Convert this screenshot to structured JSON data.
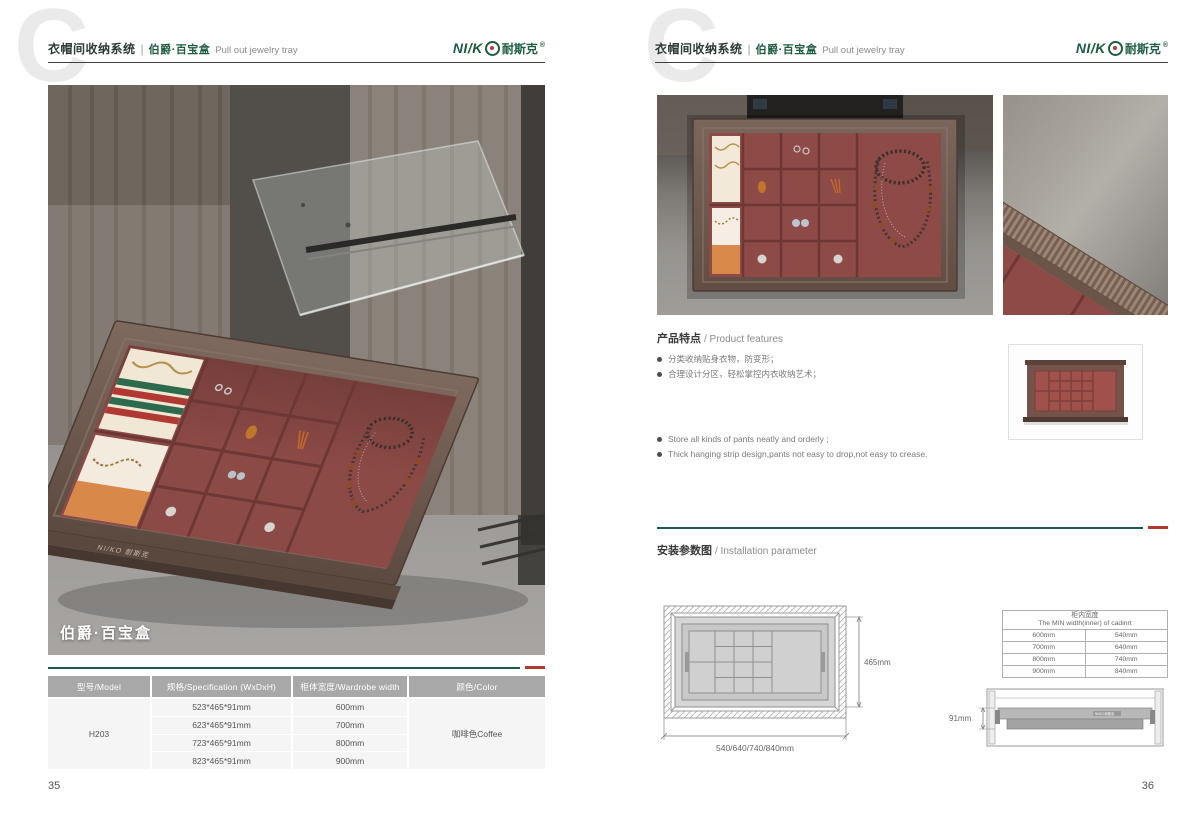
{
  "header": {
    "watermark": "C",
    "system_zh": "衣帽间收纳系统",
    "divider": "|",
    "product_zh": "伯爵·百宝盒",
    "product_en": "Pull out jewelry tray",
    "logo_latin": "NI/K",
    "logo_zh": "耐斯克",
    "logo_reg": "®"
  },
  "left_page": {
    "page_number": "35",
    "photo_caption": "伯爵·百宝盒",
    "brand_small": "NI/KO 耐斯克",
    "spec_table": {
      "col_model": "型号/Model",
      "col_spec": "规格/Specification (WxDxH)",
      "col_width": "柜体宽度/Wardrobe width",
      "col_color": "颜色/Color",
      "model": "H203",
      "rows": [
        {
          "spec": "523*465*91mm",
          "width": "600mm"
        },
        {
          "spec": "623*465*91mm",
          "width": "700mm"
        },
        {
          "spec": "723*465*91mm",
          "width": "800mm"
        },
        {
          "spec": "823*465*91mm",
          "width": "900mm"
        }
      ],
      "color": "咖啡色Coffee"
    }
  },
  "right_page": {
    "page_number": "36",
    "features": {
      "title_zh": "产品特点",
      "title_en": "/ Product features",
      "bullets_zh": [
        "分类收纳贴身衣物，防变形；",
        "合理设计分区，轻松掌控内衣收纳艺术；"
      ],
      "bullets_en": [
        "Store all kinds of pants neatly and orderly ;",
        "Thick hanging strip design,pants not easy to drop,not easy to crease."
      ]
    },
    "installation": {
      "title_zh": "安装参数图",
      "title_en": "/ Installation parameter",
      "dim_depth": "465mm",
      "dim_widths": "540/640/740/840mm",
      "dim_height": "91mm",
      "min_width_table": {
        "title_zh": "柜内宽度",
        "title_en": "The MIN width(inner) of cadinrt",
        "rows": [
          {
            "wardrobe": "600mm",
            "inner": "540mm"
          },
          {
            "wardrobe": "700mm",
            "inner": "640mm"
          },
          {
            "wardrobe": "800mm",
            "inner": "740mm"
          },
          {
            "wardrobe": "900mm",
            "inner": "840mm"
          }
        ]
      }
    }
  },
  "colors": {
    "brand_green": "#1d5c42",
    "accent_red": "#b03a30",
    "table_header_gray": "#a8a8a8",
    "tray_burgundy": "#8c4a46",
    "frame_brown": "#6f5a50"
  }
}
